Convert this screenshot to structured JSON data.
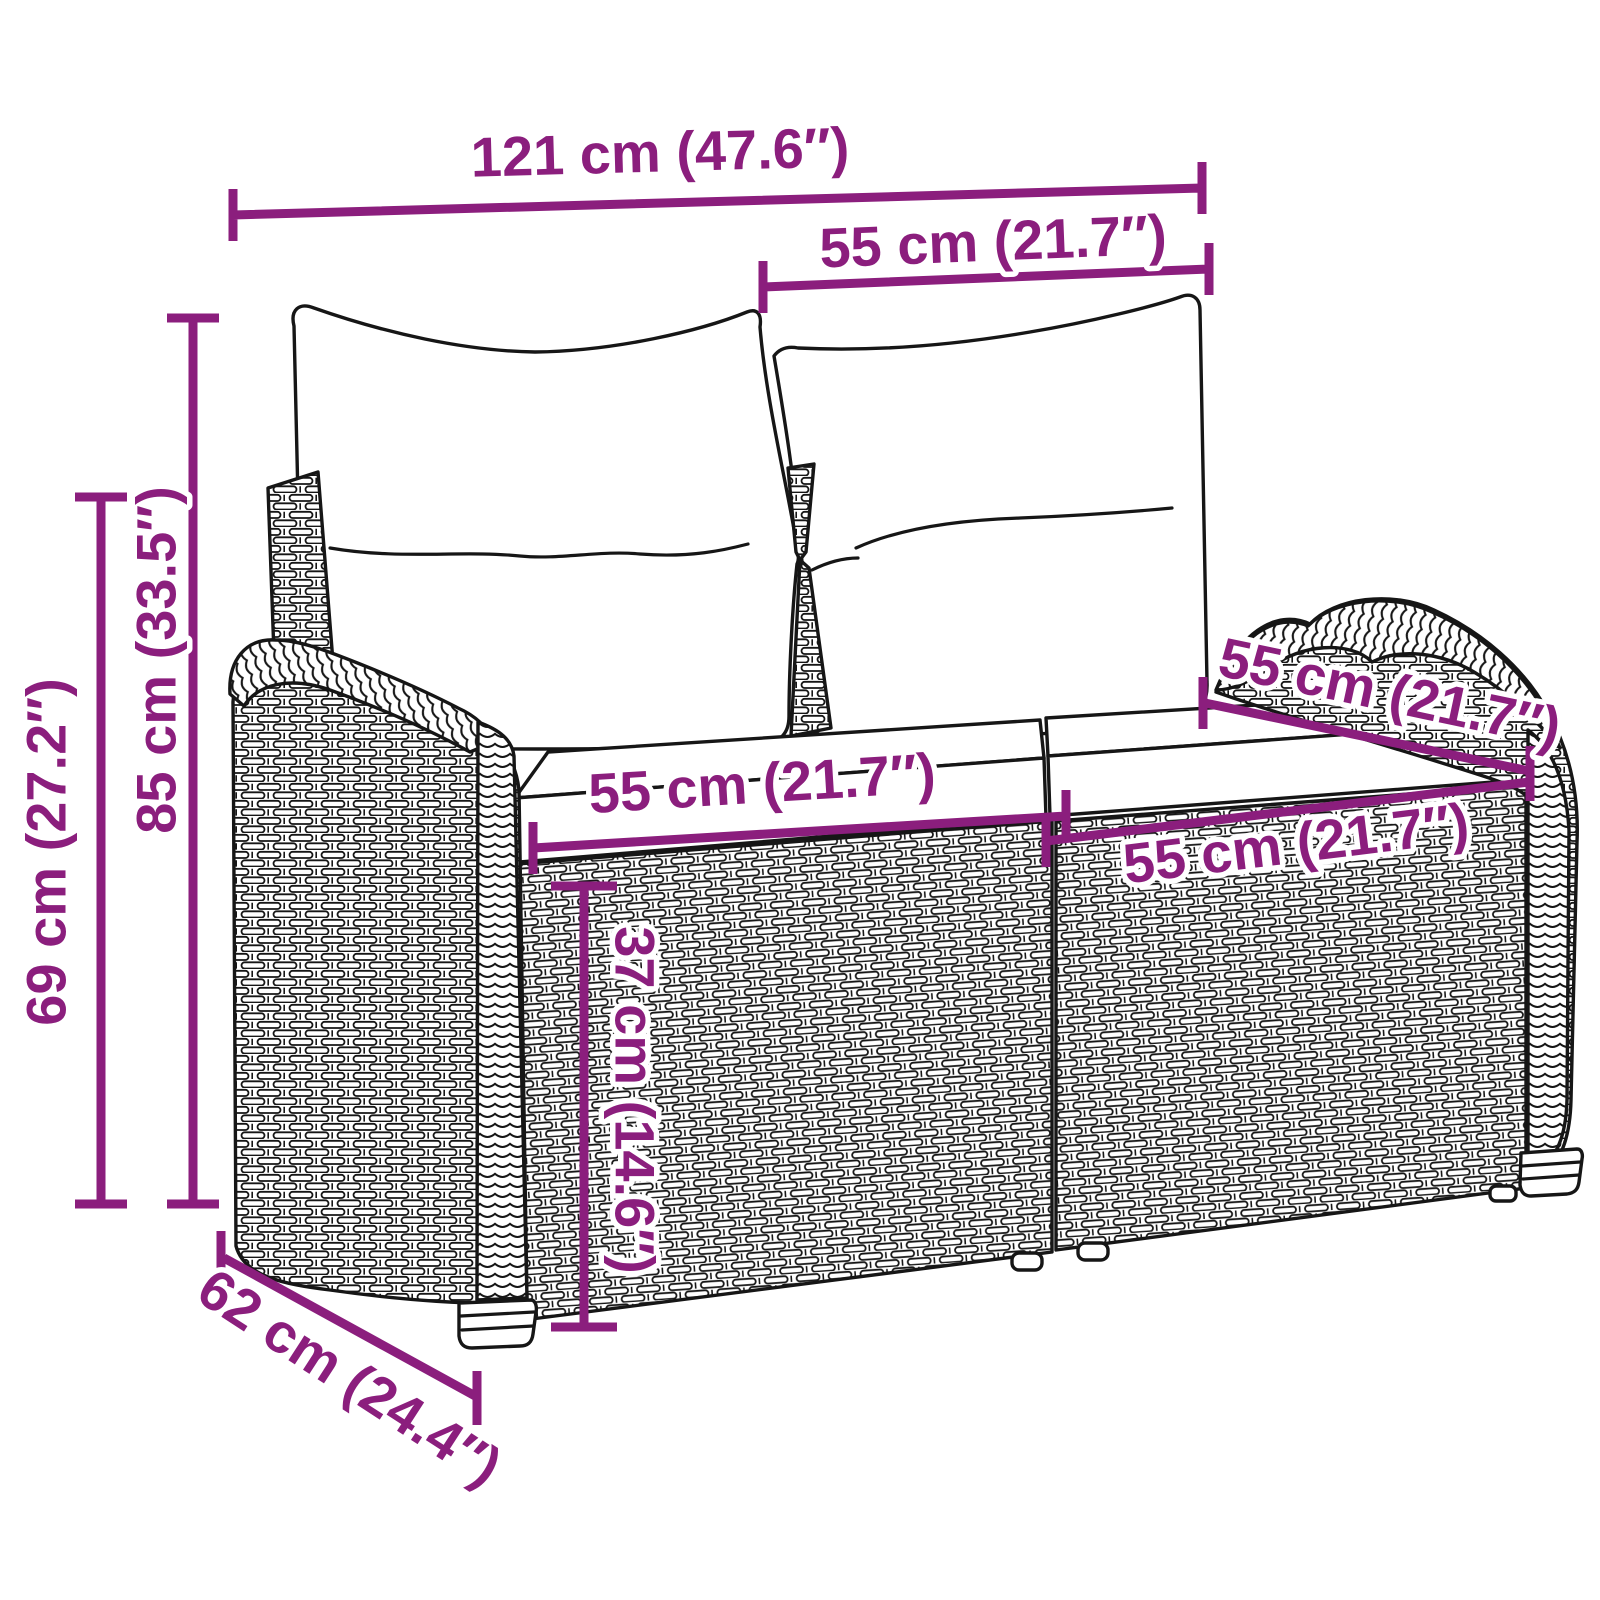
{
  "style": {
    "accent_color": "#8B1E7D",
    "art_line_color": "#161616",
    "background": "#ffffff"
  },
  "illustration": {
    "description": "Two-seater poly rattan garden bench with two back cushions and two seat cushions, drawn as black line art with woven texture"
  },
  "dimensions": {
    "overall_width": {
      "label": "121 cm (47.6″)",
      "cm": 121,
      "inches": 47.6
    },
    "backrest_width": {
      "label": "55 cm (21.7″)",
      "cm": 55,
      "inches": 21.7
    },
    "total_height": {
      "label": "85 cm (33.5″)",
      "cm": 85,
      "inches": 33.5
    },
    "armrest_height": {
      "label": "69 cm (27.2″)",
      "cm": 69,
      "inches": 27.2
    },
    "seat_width_left": {
      "label": "55 cm (21.7″)",
      "cm": 55,
      "inches": 21.7
    },
    "seat_width_right": {
      "label": "55 cm (21.7″)",
      "cm": 55,
      "inches": 21.7
    },
    "seat_depth": {
      "label": "55 cm (21.7″)",
      "cm": 55,
      "inches": 21.7
    },
    "seat_height": {
      "label": "37 cm (14.6″)",
      "cm": 37,
      "inches": 14.6
    },
    "overall_depth": {
      "label": "62 cm (24.4″)",
      "cm": 62,
      "inches": 24.4
    }
  }
}
